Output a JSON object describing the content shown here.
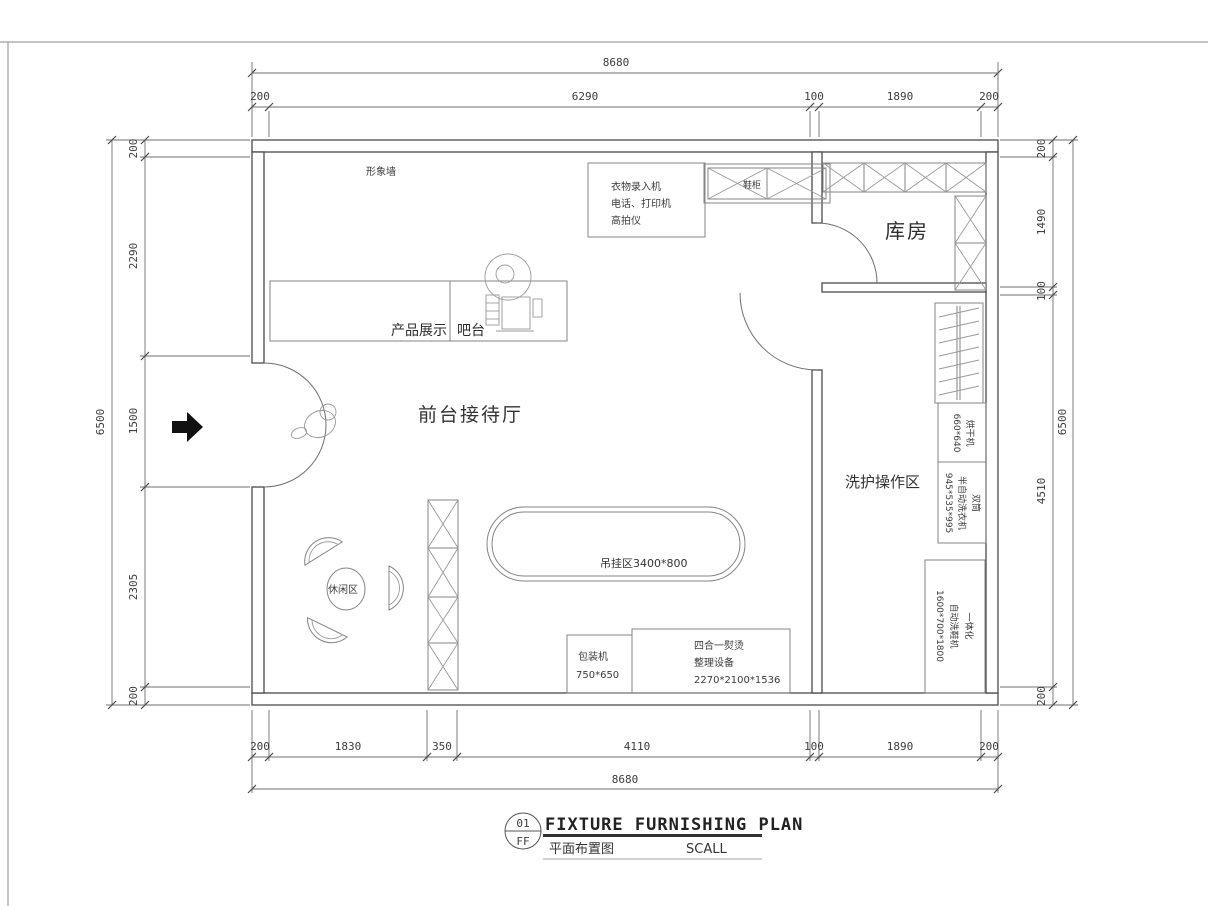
{
  "sheet": {
    "title_block": {
      "drawing_number": "01",
      "drawing_code": "FF",
      "title_en": "FIXTURE FURNISHING PLAN",
      "title_cn": "平面布置图",
      "scale_label": "SCALL"
    },
    "colors": {
      "ink": "#4a4a4a",
      "light_line": "#858585",
      "arrow_fill": "#111111",
      "background": "#ffffff"
    }
  },
  "rooms": {
    "reception": "前台接待厅",
    "storage": "库房",
    "washing_area": "洗护操作区",
    "leisure_area": "休闲区"
  },
  "labels": {
    "image_wall": "形象墙",
    "product_display": "产品展示",
    "bar_counter": "吧台",
    "shoe_cabinet": "鞋柜",
    "hanging_zone": "吊挂区3400*800"
  },
  "equipment": {
    "intake_station": {
      "line1": "衣物录入机",
      "line2": "电话、打印机",
      "line3": "高拍仪"
    },
    "packing_machine": {
      "line1": "包装机",
      "line2": "750*650"
    },
    "ironing_equipment": {
      "line1": "四合一熨烫",
      "line2": "整理设备",
      "line3": "2270*2100*1536"
    },
    "dryer": {
      "line1": "烘干机",
      "line2": "660*640"
    },
    "washer": {
      "line1": "双筒",
      "line2": "半自动洗衣机",
      "line3": "945*535*995"
    },
    "shoe_washer": {
      "line1": "一体化",
      "line2": "自动洗鞋机",
      "line3": "1600*700*1800"
    }
  },
  "dimensions": {
    "top": {
      "total": "8680",
      "segments": [
        "200",
        "6290",
        "100",
        "1890",
        "200"
      ]
    },
    "bottom": {
      "total": "8680",
      "segments": [
        "200",
        "1830",
        "350",
        "4110",
        "100",
        "1890",
        "200"
      ]
    },
    "left": {
      "total": "6500",
      "segments": [
        "200",
        "2290",
        "1500",
        "2305",
        "200"
      ]
    },
    "right": {
      "total": "6500",
      "segments": [
        "200",
        "1490",
        "100",
        "4510",
        "200"
      ]
    }
  }
}
